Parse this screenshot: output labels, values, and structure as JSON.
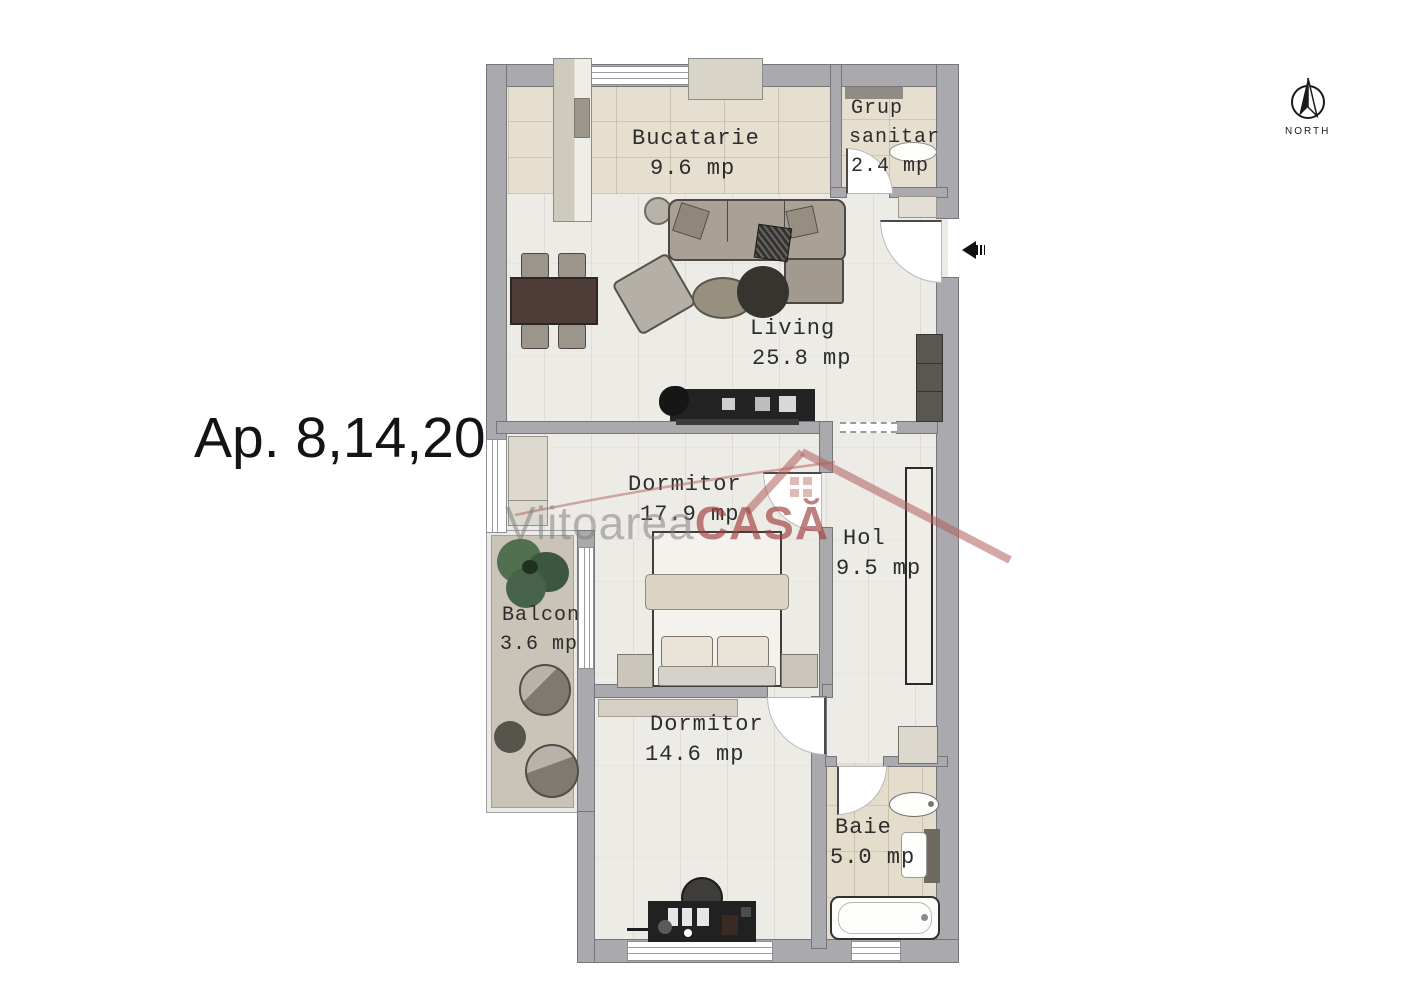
{
  "plan": {
    "apartment_label": "Ap. 8,14,20"
  },
  "compass": {
    "label": "NORTH"
  },
  "watermark": {
    "brand_gray": "Viitoarea",
    "brand_red": "CASĂ"
  },
  "rooms": {
    "bucatarie": {
      "name": "Bucatarie",
      "area": "9.6 mp"
    },
    "grup_sanitar": {
      "name_line1": "Grup",
      "name_line2": "sanitar",
      "area": "2.4 mp"
    },
    "living": {
      "name": "Living",
      "area": "25.8 mp"
    },
    "dormitor_mare": {
      "name": "Dormitor",
      "area": "17.9 mp"
    },
    "hol": {
      "name": "Hol",
      "area": "9.5 mp"
    },
    "balcon": {
      "name": "Balcon",
      "area": "3.6 mp"
    },
    "dormitor_mic": {
      "name": "Dormitor",
      "area": "14.6 mp"
    },
    "baie": {
      "name": "Baie",
      "area": "5.0 mp"
    }
  },
  "colors": {
    "wall": "#a9a9ae",
    "wall_outline": "#76767a",
    "floor_main": "#edebe6",
    "floor_tile": "#e6dfd0",
    "balcony_floor": "#cac4b8",
    "watermark_red": "#9e3e3c",
    "watermark_gray": "#828282"
  }
}
